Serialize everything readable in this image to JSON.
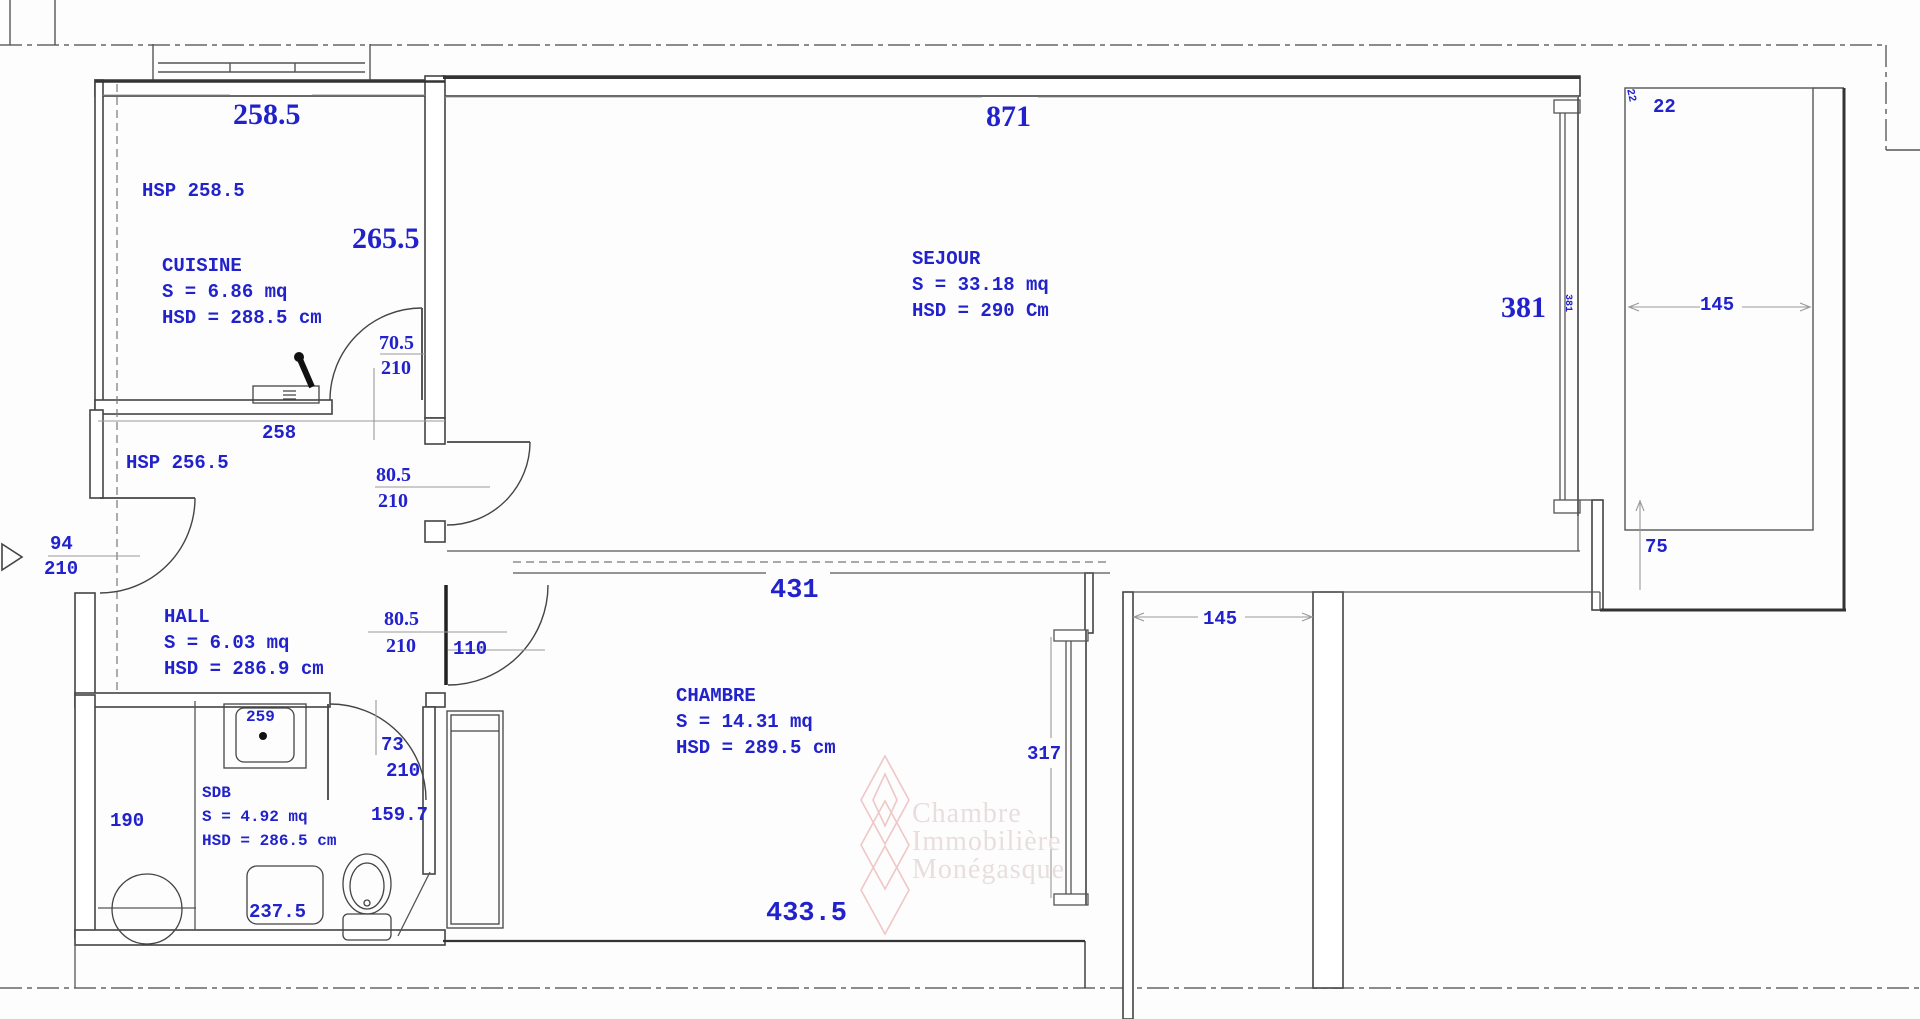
{
  "colors": {
    "dimension_text": "#2222cc",
    "wall_line": "#444444",
    "watermark_pink": "#f0c6c6",
    "watermark_text": "#e9dede"
  },
  "watermark": {
    "line1": "Chambre",
    "line2": "Immobilière",
    "line3": "Monégasque"
  },
  "rooms": {
    "cuisine": {
      "hsp": "HSP 258.5",
      "name": "CUISINE",
      "area": "S = 6.86 mq",
      "height": "HSD = 288.5 cm"
    },
    "sejour": {
      "name": "SEJOUR",
      "area": "S = 33.18 mq",
      "height": "HSD = 290 Cm"
    },
    "hall": {
      "hsp": "HSP 256.5",
      "name": "HALL",
      "area": "S = 6.03 mq",
      "height": "HSD = 286.9 cm"
    },
    "chambre": {
      "name": "CHAMBRE",
      "area": "S = 14.31 mq",
      "height": "HSD = 289.5 cm"
    },
    "sdb": {
      "name": "SDB",
      "area": "S = 4.92 mq",
      "height": "HSD = 286.5 cm"
    }
  },
  "dimensions": {
    "kitchen_top": "258.5",
    "kitchen_right": "265.5",
    "sejour_top": "871",
    "sejour_right": "381",
    "sejour_right_small": "381",
    "hall_top": "258",
    "chambre_top": "431",
    "chambre_bottom": "433.5",
    "chambre_right": "317",
    "corridor_width": "145",
    "balcony_width": "145",
    "balcony_notch": "22",
    "balcony_notch_small": "22",
    "balcony_step": "75",
    "entry_door_width": "94",
    "entry_door_height": "210",
    "kitchen_door_width": "70.5",
    "kitchen_door_height": "210",
    "sejour_door_width": "80.5",
    "sejour_door_height": "210",
    "chambre_door_width": "80.5",
    "chambre_door_height": "210",
    "chambre_door_clear": "110",
    "sdb_door_width": "73",
    "sdb_door_height": "210",
    "sdb_left": "190",
    "sdb_basin": "259",
    "sdb_bottom": "237.5",
    "sdb_right": "159.7"
  }
}
